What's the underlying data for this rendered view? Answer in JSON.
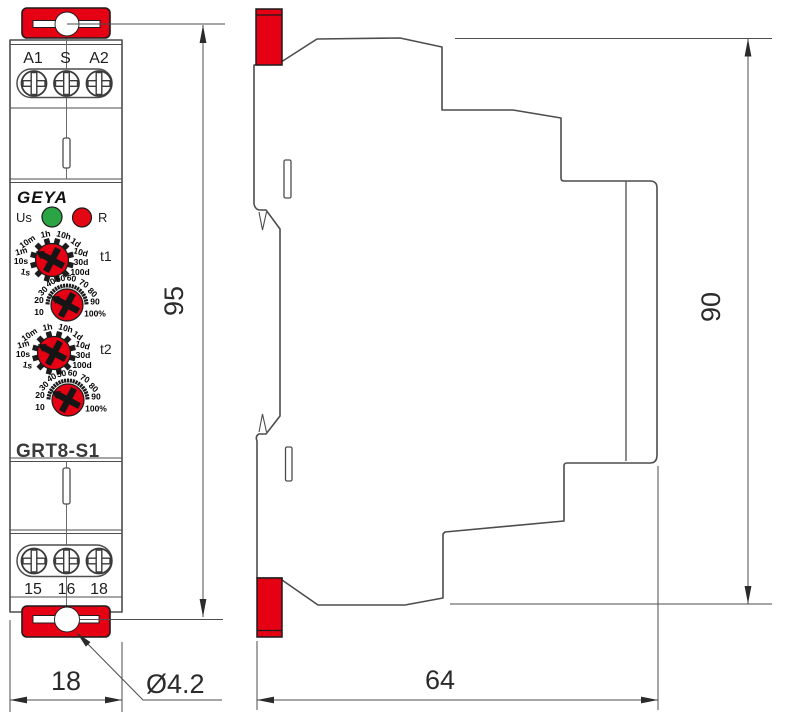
{
  "front_view": {
    "brand": "GEYA",
    "model": "GRT8-S1",
    "terminals_top": [
      "A1",
      "S",
      "A2"
    ],
    "terminals_bottom": [
      "15",
      "16",
      "18"
    ],
    "led_labels": {
      "us": "Us",
      "r": "R"
    },
    "dial_labels": {
      "t1": "t1",
      "t2": "t2"
    },
    "time_scale": [
      "1h",
      "10h",
      "10m",
      "1d",
      "1m",
      "10d",
      "10s",
      "30d",
      "1s",
      "100d"
    ],
    "percent_scale": [
      "40",
      "50",
      "60",
      "70",
      "30",
      "80",
      "20",
      "90",
      "10",
      "100%"
    ]
  },
  "dimensions": {
    "front_height": "95",
    "front_width": "18",
    "side_height": "90",
    "side_depth": "64",
    "mount_hole": "Ø4.2"
  },
  "colors": {
    "accent_red": "#e60013",
    "led_green": "#2ba544",
    "led_red": "#e30613",
    "line_gray": "#4d4d4d"
  }
}
